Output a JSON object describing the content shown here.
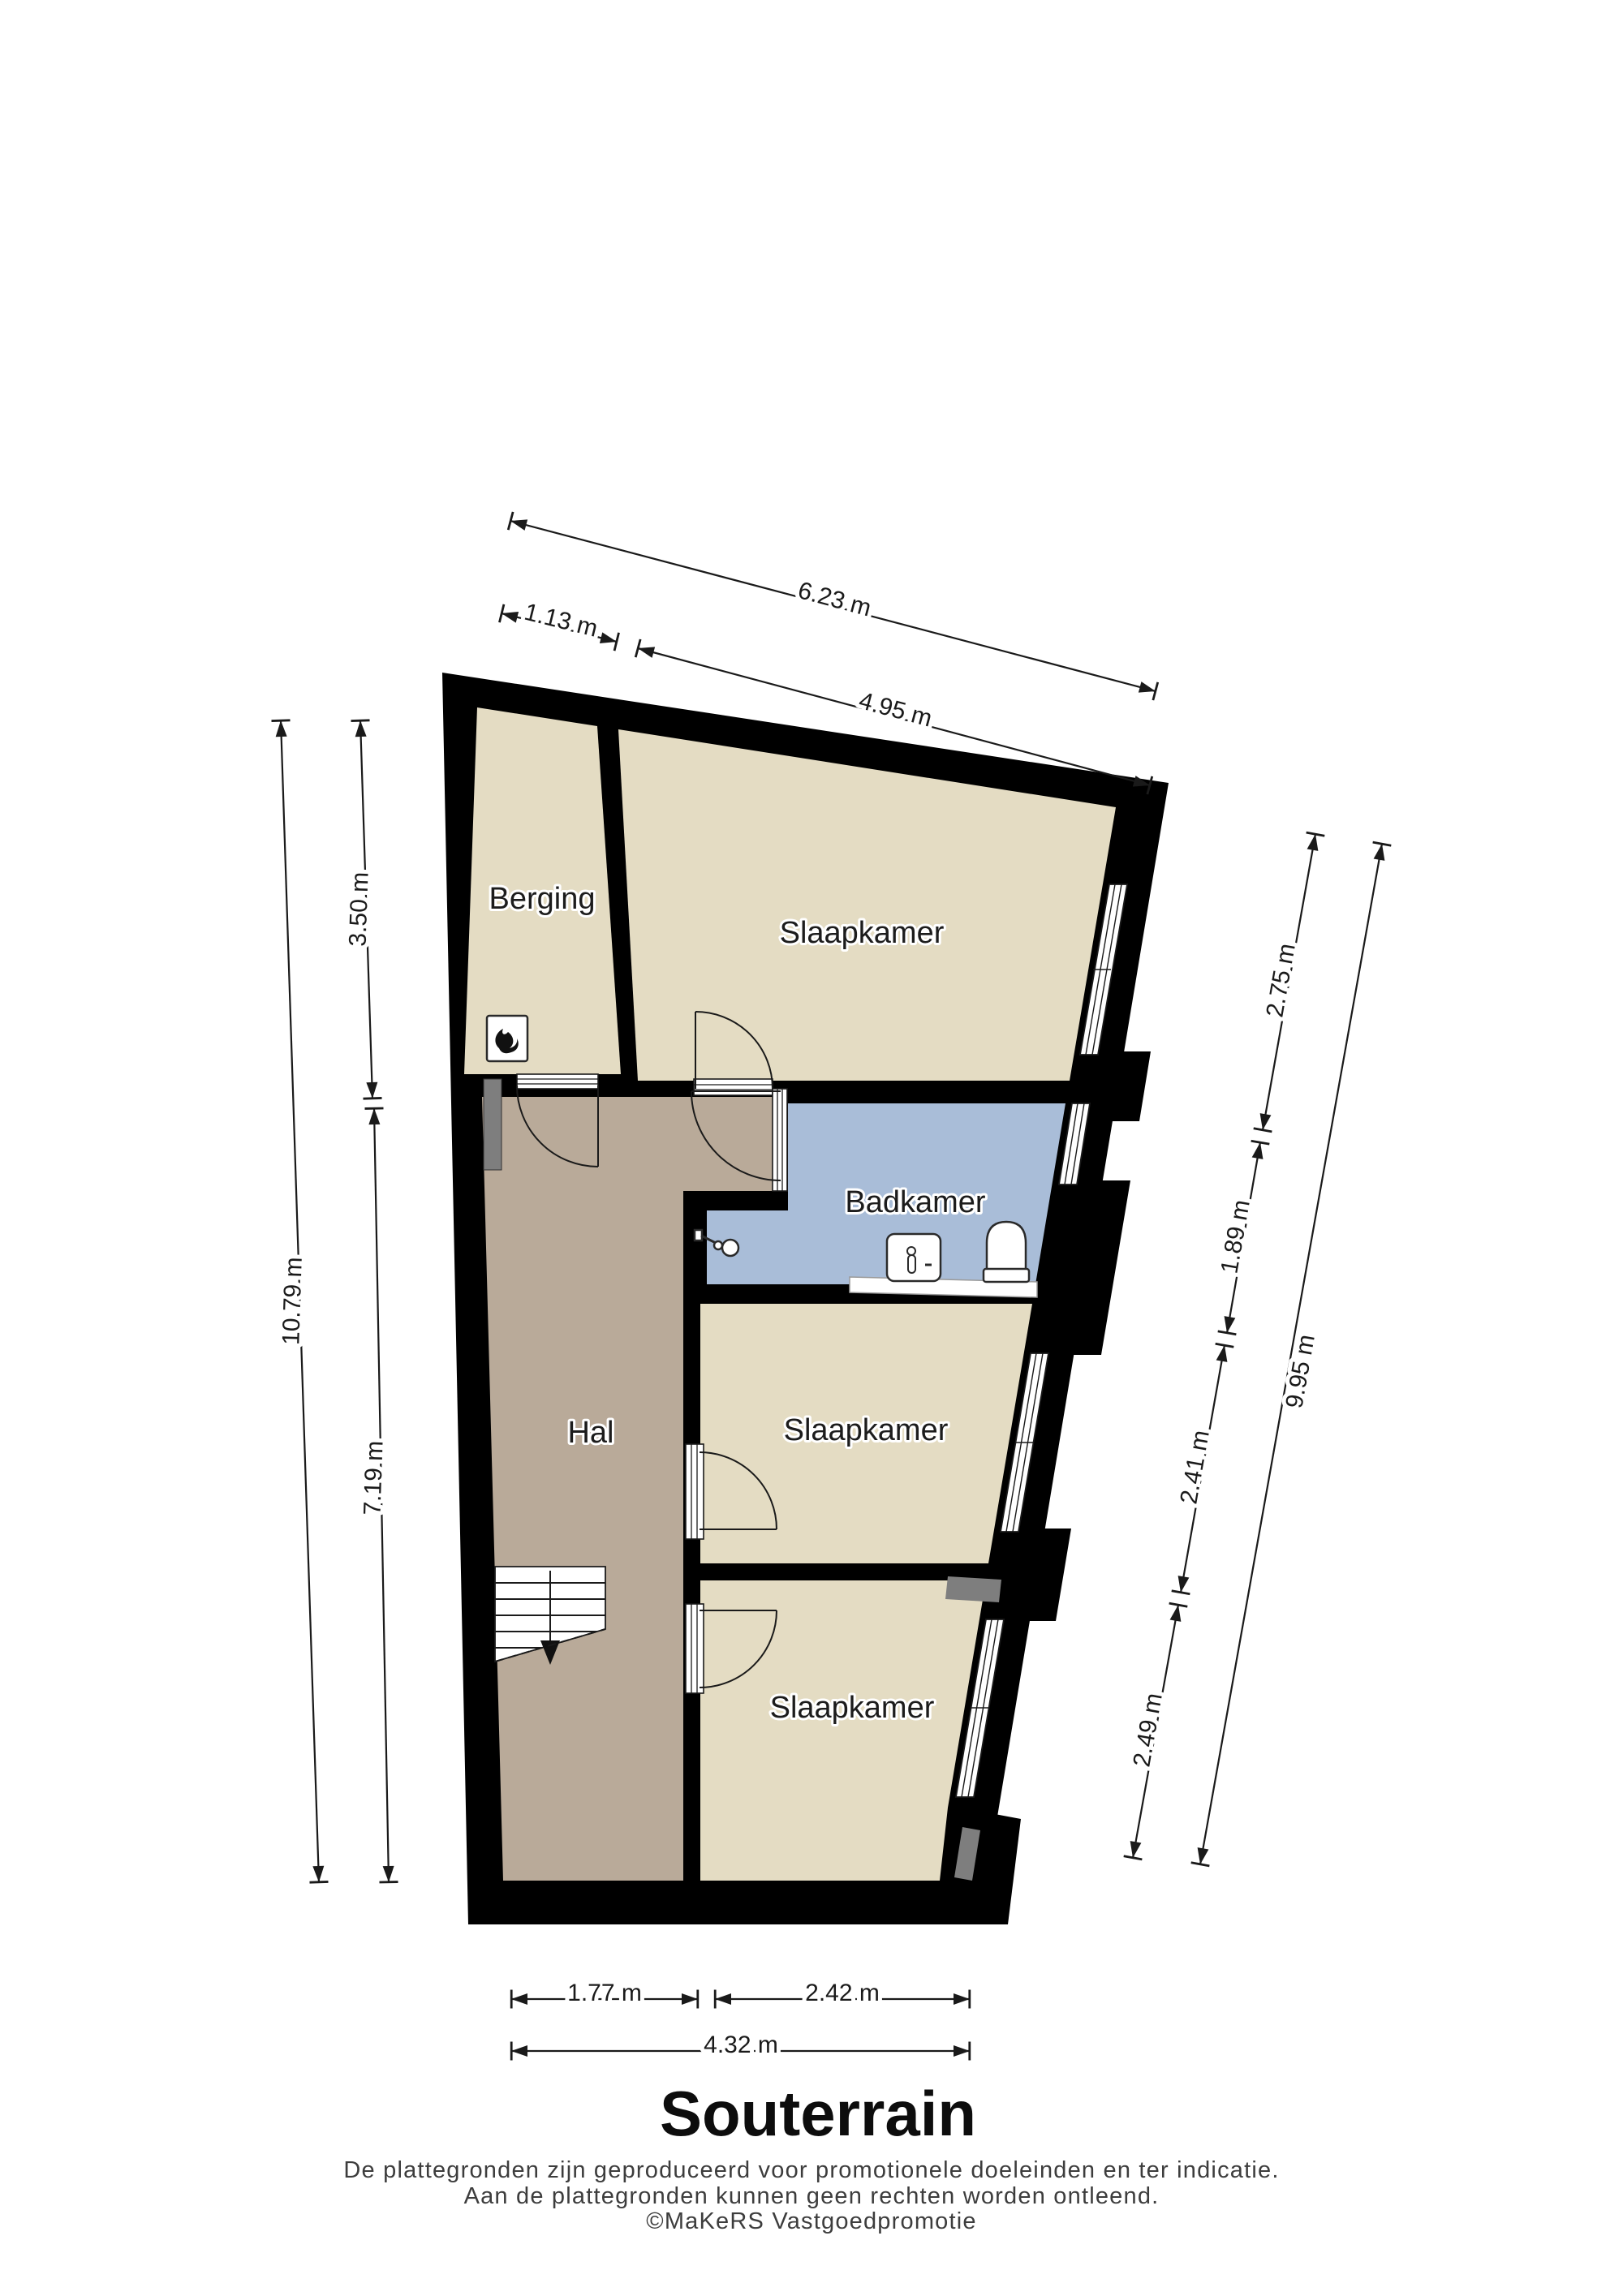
{
  "title": "Souterrain",
  "footer": {
    "line1": "De plattegronden zijn geproduceerd voor promotionele doeleinden en ter indicatie.",
    "line2": "Aan de plattegronden kunnen geen rechten worden ontleend.",
    "line3": "©MaKeRS Vastgoedpromotie"
  },
  "rooms": {
    "berging": "Berging",
    "slaapkamer_top": "Slaapkamer",
    "badkamer": "Badkamer",
    "hal": "Hal",
    "slaapkamer_mid": "Slaapkamer",
    "slaapkamer_bottom": "Slaapkamer"
  },
  "dimensions": {
    "top": {
      "total": "6.23 m",
      "berging": "1.13 m",
      "slaapkamer": "4.95 m"
    },
    "left": {
      "total": "10.79 m",
      "upper": "3.50 m",
      "lower": "7.19 m"
    },
    "right": {
      "total": "9.95 m",
      "segments": [
        "2.75 m",
        "1.89 m",
        "2.41 m",
        "2.49 m"
      ]
    },
    "bottom": {
      "hal": "1.77 m",
      "slaapkamer": "2.42 m",
      "total": "4.32 m"
    }
  },
  "colors": {
    "wall": "#000000",
    "room_floor": "#e4dcc3",
    "hall_floor": "#b9aa99",
    "bath_floor": "#a9bdd8",
    "niche": "#7e7e7e"
  }
}
